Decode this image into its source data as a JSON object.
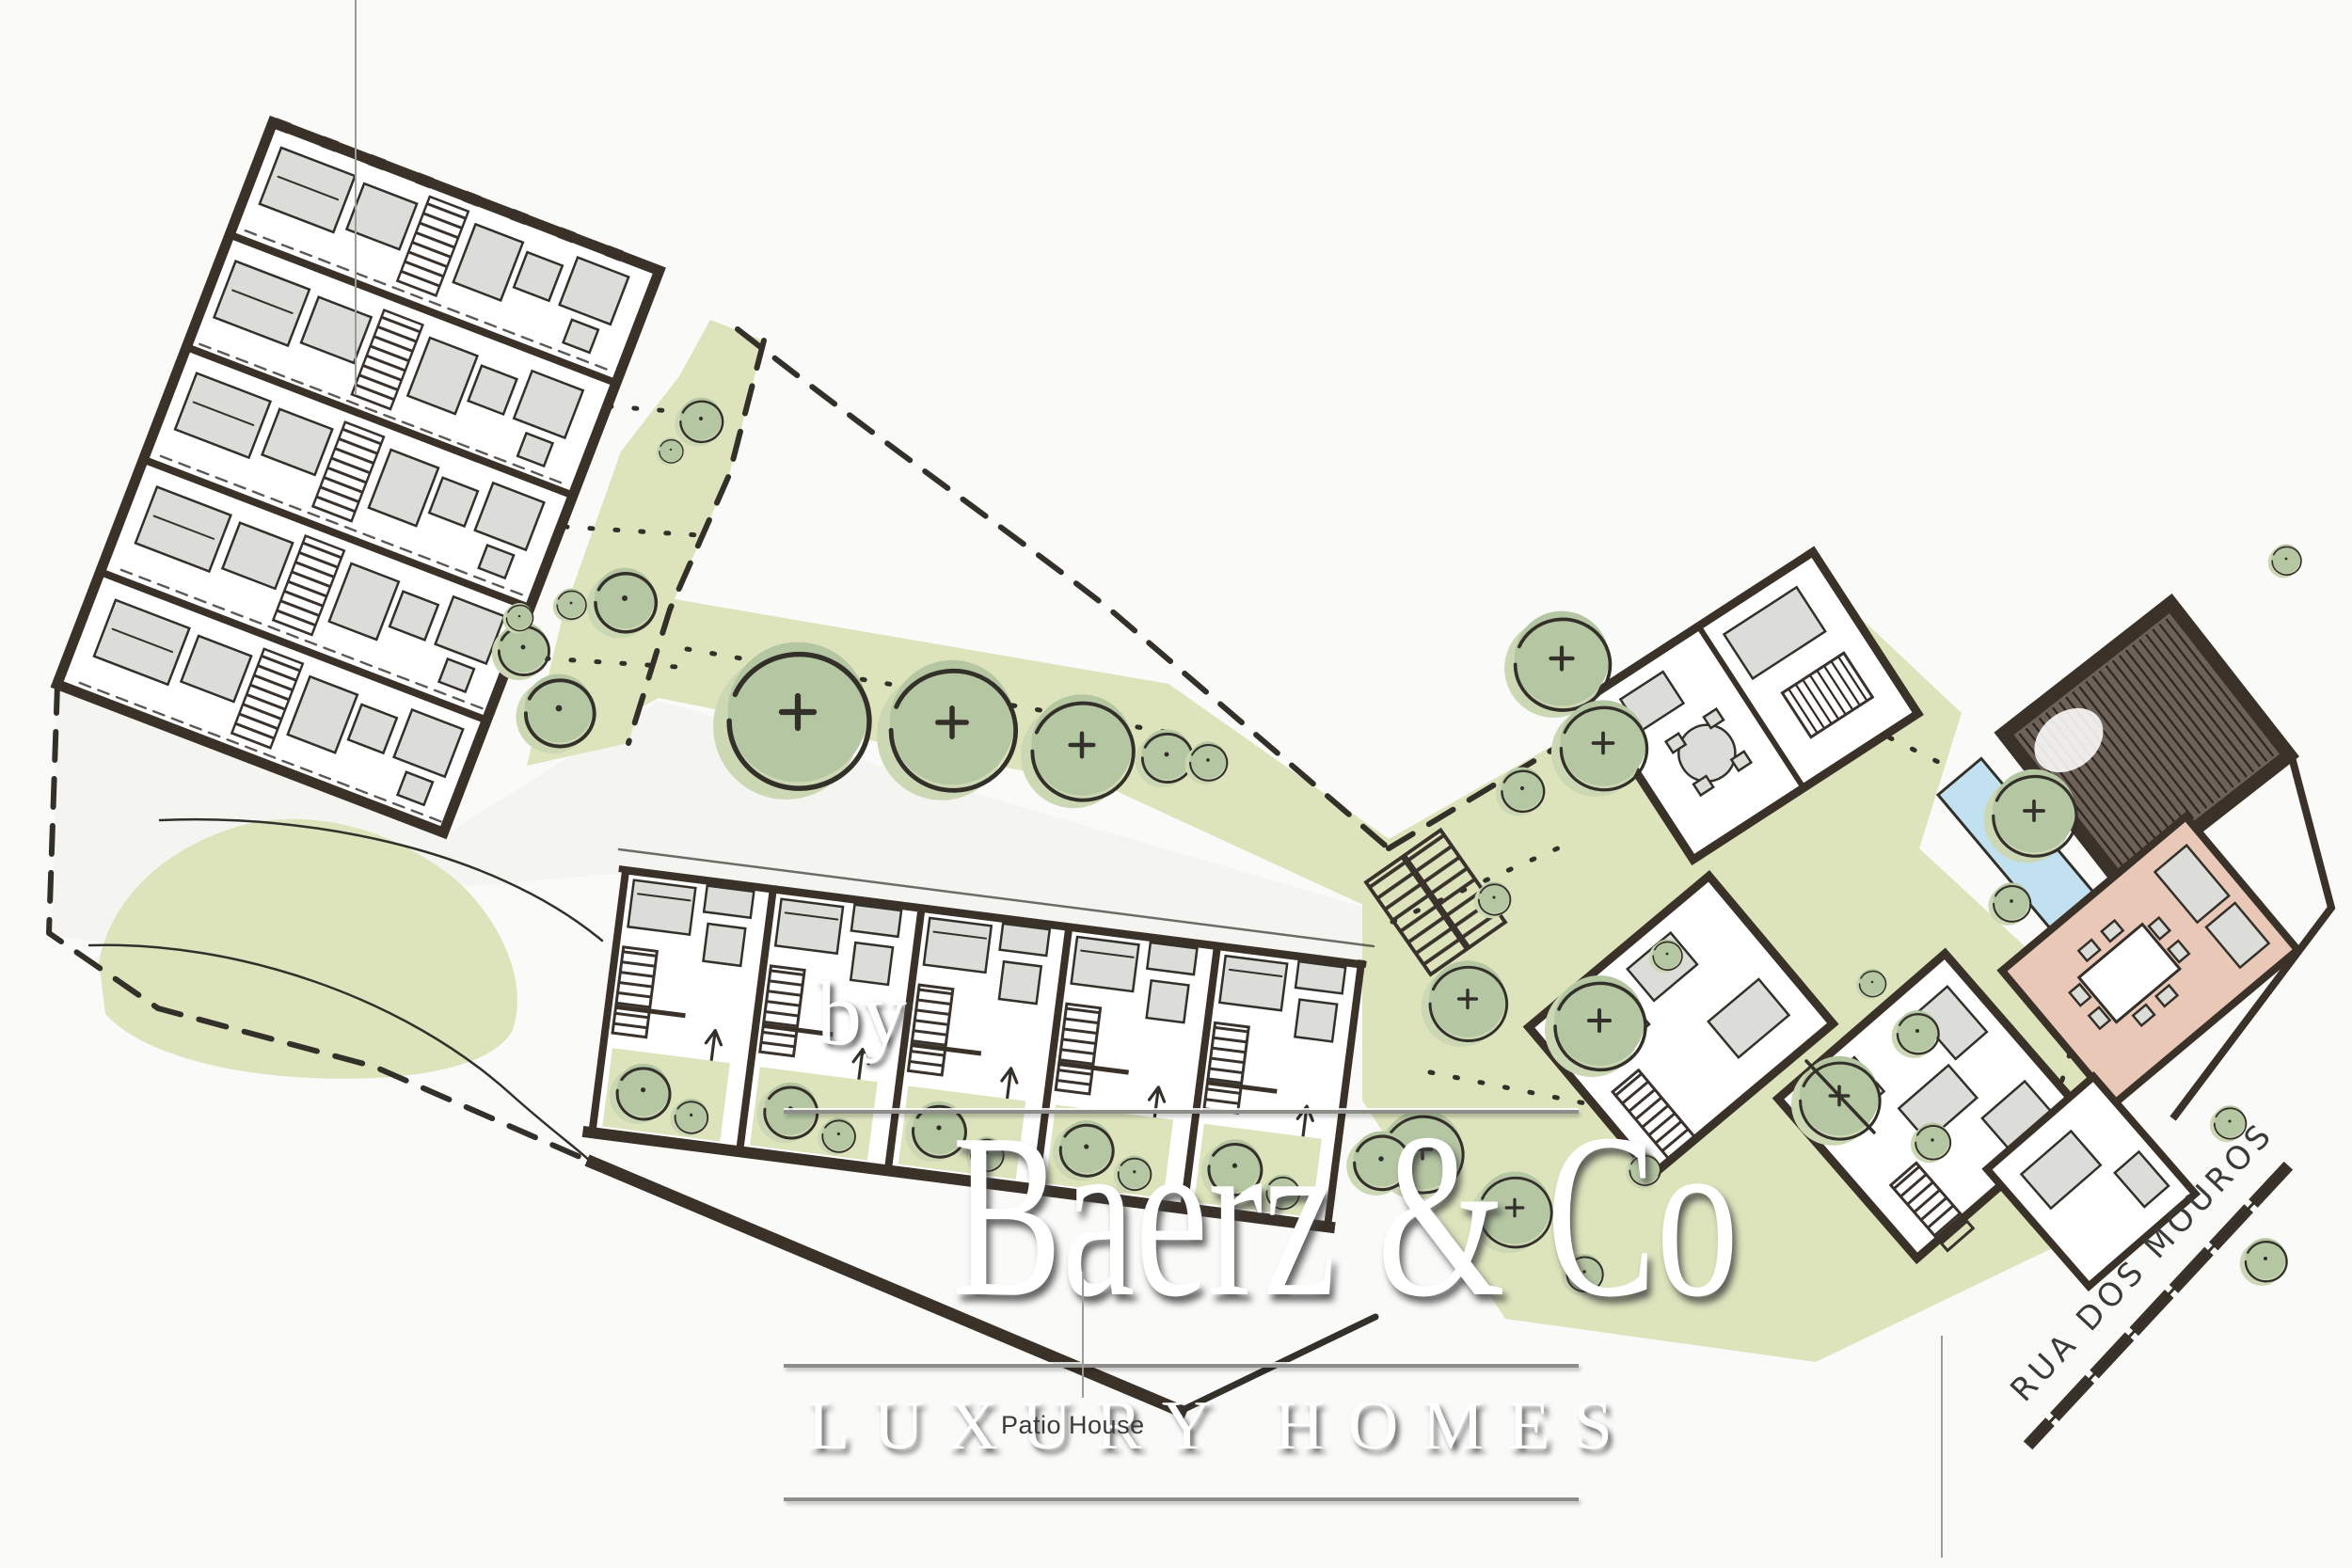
{
  "watermark": {
    "prefix": "by",
    "brand": "Baerz & Co",
    "tagline": "LUXURY HOMES"
  },
  "plan": {
    "unit_label": "Patio House",
    "street_label": "RUA DOS MOUROS"
  },
  "colors": {
    "paper": "#fafaf8",
    "road": "#ededea",
    "lawn": "#dde4bc",
    "tree": "#b5c6a2",
    "tree_shadow": "#ccd7b4",
    "ink": "#33302a",
    "wall": "#3a3129",
    "furniture": "#dcdcd8",
    "roof": "#6e6157",
    "pool": "#c2e1f0",
    "pink": "#eac8b7",
    "watermark": "#ffffff",
    "label": "#3a3a38",
    "guide": "#9b9b97"
  }
}
